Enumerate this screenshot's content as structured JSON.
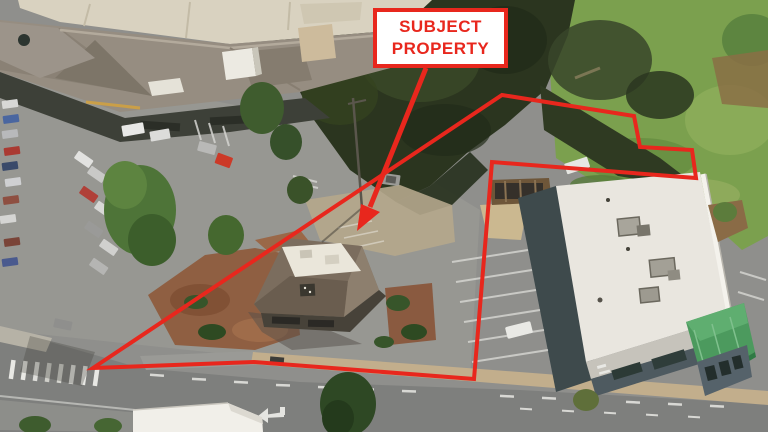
{
  "annotation": {
    "label": "SUBJECT PROPERTY",
    "colors": {
      "annotation_red": "#e8271d",
      "label_background": "#ffffff"
    },
    "boundary_points": "93,368 502,95 634,116 640,147 692,150 696,178 492,162 474,379 254,362",
    "arrow_shaft_path": "M426,68 L370,207",
    "arrow_head_points": "357,231 361,204 380,212"
  },
  "scene": {
    "kind": "oblique-aerial-photo",
    "features": [
      "shopping-center",
      "parking-lot",
      "subject-parcel",
      "subject-building",
      "retail-building",
      "hillside-vegetation",
      "road",
      "crosswalk"
    ]
  }
}
